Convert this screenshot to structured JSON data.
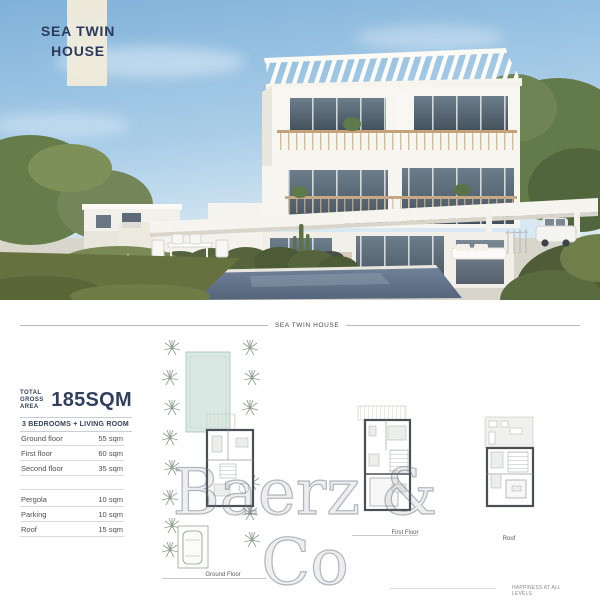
{
  "photo": {
    "title_line1": "SEA TWIN",
    "title_line2": "HOUSE"
  },
  "section_header": "SEA TWIN HOUSE",
  "specs": {
    "total_label_line1": "TOTAL",
    "total_label_line2": "GROSS AREA",
    "total_value": "185SQM",
    "subtitle": "3 BEDROOMS + LIVING ROOM"
  },
  "area_table": {
    "main_rows": [
      {
        "label": "Ground floor",
        "value": "55 sqm"
      },
      {
        "label": "First floor",
        "value": "60 sqm"
      },
      {
        "label": "Second floor",
        "value": "35 sqm"
      }
    ],
    "extra_rows": [
      {
        "label": "Pergola",
        "value": "10 sqm"
      },
      {
        "label": "Parking",
        "value": "10 sqm"
      },
      {
        "label": "Roof",
        "value": "15 sqm"
      }
    ]
  },
  "plans": {
    "ground": {
      "label": "Ground Floor"
    },
    "first": {
      "label": "First Floor"
    },
    "roof": {
      "label": "Roof"
    }
  },
  "watermark": {
    "line1": "Baerz & Co",
    "line2": "LUXURY HOMES"
  },
  "footer_note": "HAPPINESS AT ALL LEVELS",
  "colors": {
    "accent_navy": "#2c3a5a",
    "sky_blue": "#8ebcdf",
    "pool_water": "#5f7186",
    "plan_pool_teal": "#d9e8e2",
    "grass_green": "#66713f"
  }
}
